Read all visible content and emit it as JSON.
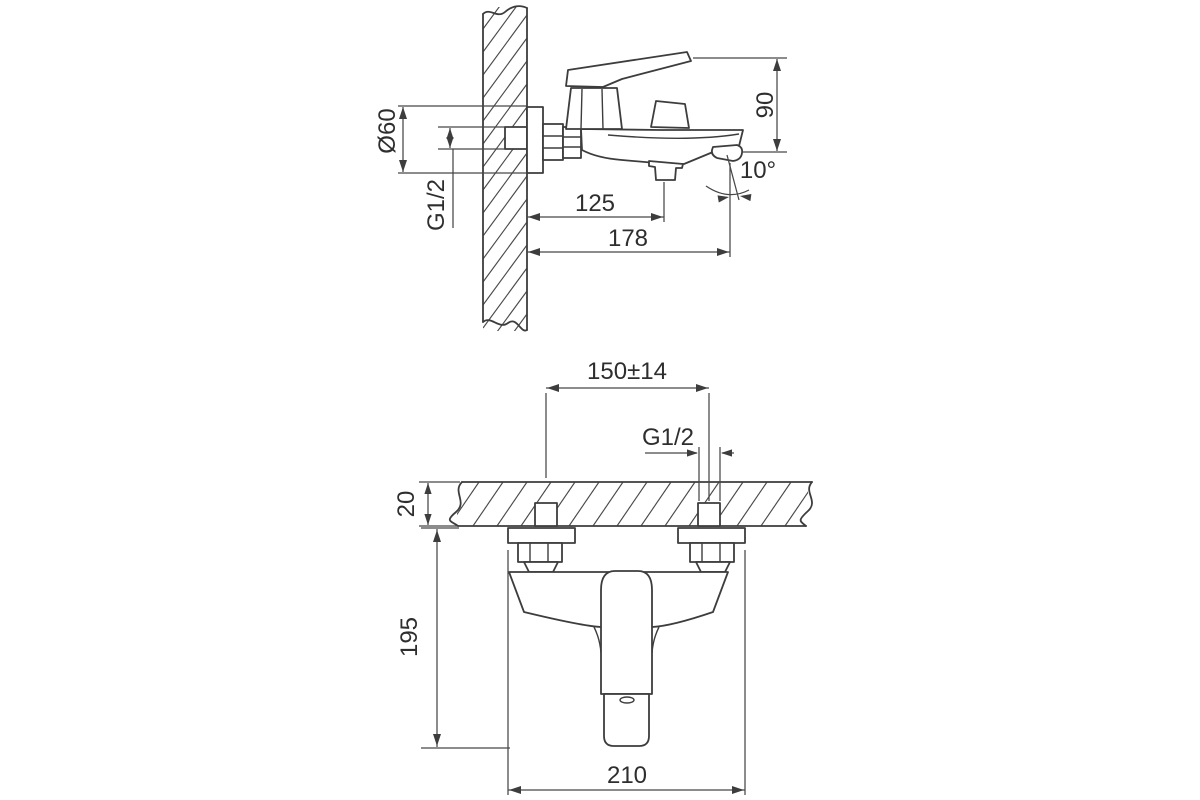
{
  "drawing": {
    "background": "#ffffff",
    "line_color": "#3d3d3d",
    "views": {
      "side_view": {
        "dimensions": {
          "flange_diameter": "Ø60",
          "thread": "G1/2",
          "wall_to_outlet": "125",
          "wall_to_spout_tip": "178",
          "height": "90",
          "spout_angle": "10°"
        }
      },
      "front_view": {
        "dimensions": {
          "connection_centers": "150±14",
          "thread": "G1/2",
          "wall_thickness": "20",
          "mount_to_spout_bottom": "195",
          "overall_width": "210"
        }
      }
    }
  }
}
